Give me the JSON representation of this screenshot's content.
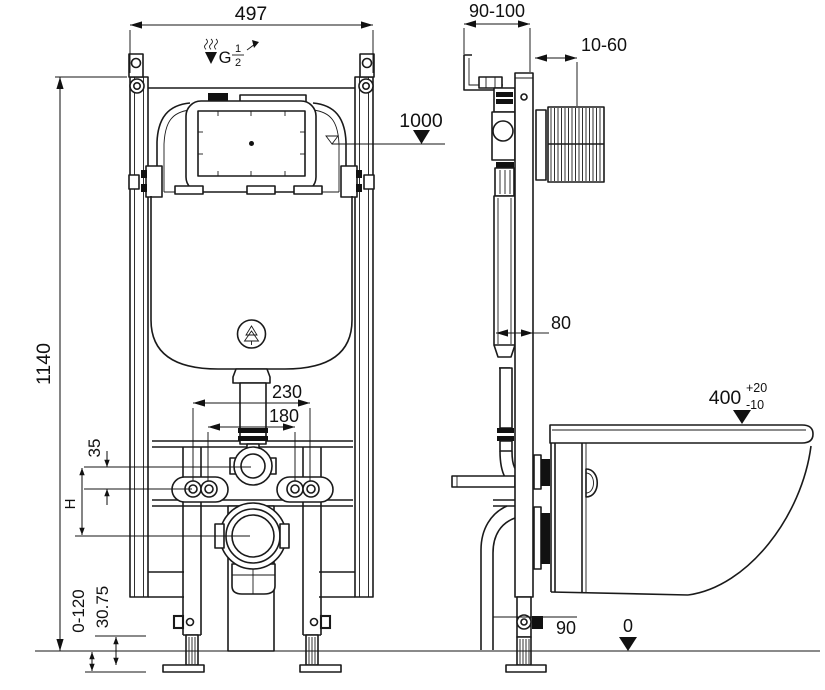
{
  "labels": {
    "front": {
      "width": "497",
      "height": "1140",
      "span_outer": "230",
      "span_inner": "180",
      "offset": "35",
      "h": "H",
      "floor_adjust": "0-120",
      "foot": "30.75"
    },
    "inlet": {
      "thread": "G",
      "frac_num": "1",
      "frac_den": "2"
    },
    "side": {
      "depth_range": "90-100",
      "finish_range": "10-60",
      "ref_level": "1000",
      "profile": "80",
      "outlet_height": "90",
      "zero": "0"
    },
    "bowl": {
      "height": "400",
      "tol_plus": "+20",
      "tol_minus": "-10"
    }
  }
}
